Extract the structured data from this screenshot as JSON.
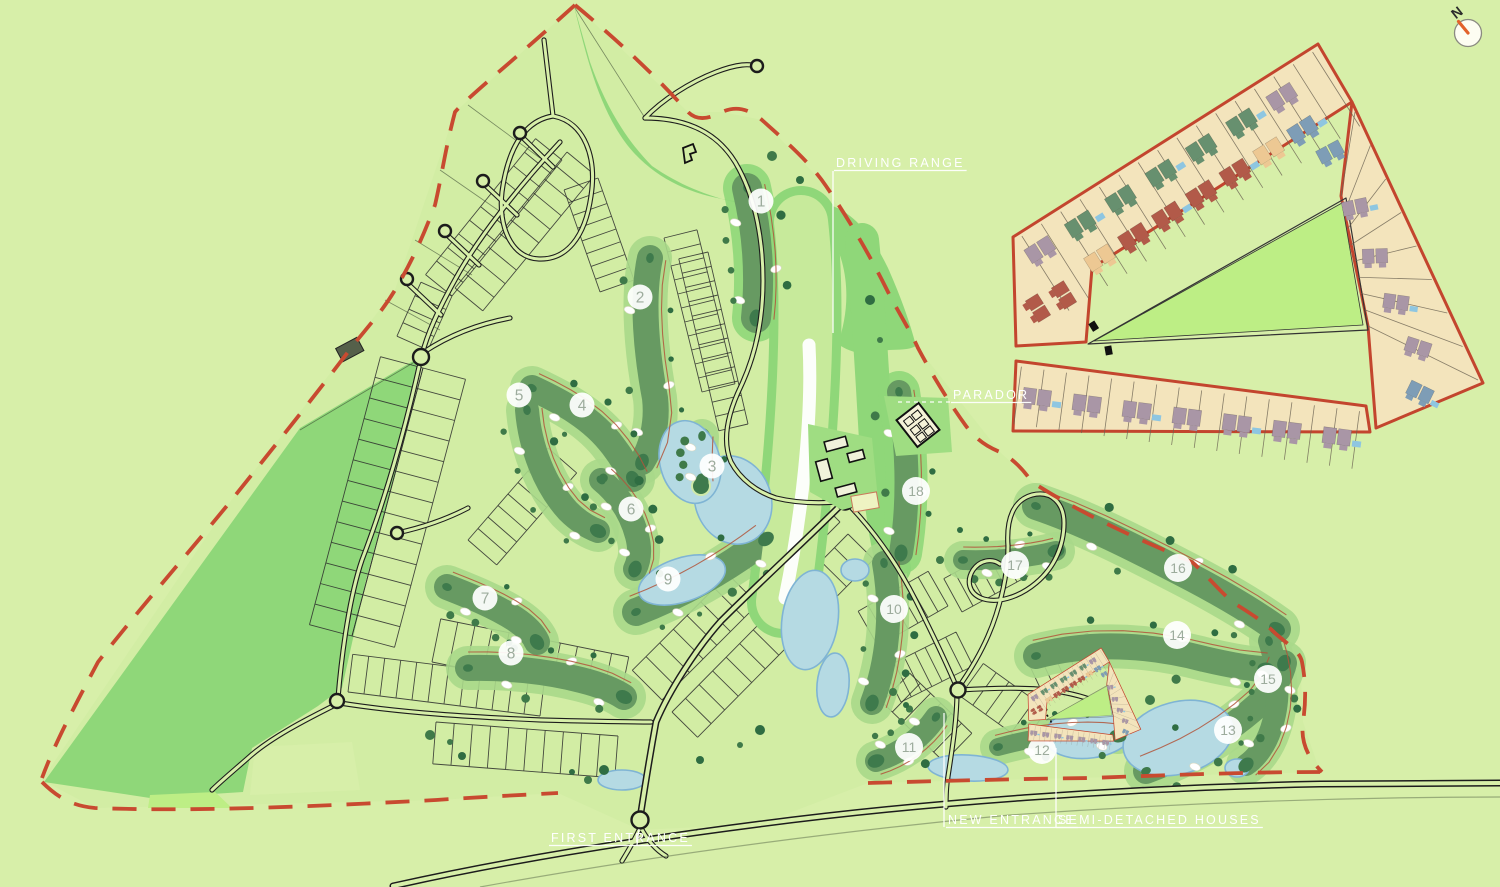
{
  "page": {
    "width": 1500,
    "height": 887
  },
  "compass": {
    "label": "N"
  },
  "labels": [
    {
      "id": "driving-range",
      "text": "DRIVING RANGE",
      "x": 836,
      "y": 167,
      "leader": [
        [
          833,
          171
        ],
        [
          833,
          333
        ]
      ],
      "dashed": false
    },
    {
      "id": "parador",
      "text": "PARADOR",
      "x": 953,
      "y": 399,
      "leader": [
        [
          898,
          402
        ],
        [
          950,
          402
        ]
      ],
      "dashed": true
    },
    {
      "id": "first-entrance",
      "text": "FIRST ENTRANCE",
      "x": 551,
      "y": 842,
      "leader": [
        [
          637,
          845
        ],
        [
          639,
          829
        ]
      ],
      "dashed": false
    },
    {
      "id": "new-entrance",
      "text": "NEW ENTRANCE",
      "x": 948,
      "y": 824,
      "leader": [
        [
          944,
          827
        ],
        [
          944,
          713
        ]
      ],
      "dashed": false
    },
    {
      "id": "semi-detached-houses",
      "text": "SEMI-DETACHED HOUSES",
      "x": 1058,
      "y": 824,
      "leader": [
        [
          1056,
          827
        ],
        [
          1056,
          748
        ]
      ],
      "dashed": false
    }
  ],
  "holes": [
    {
      "number": "1",
      "x": 761,
      "y": 201
    },
    {
      "number": "2",
      "x": 640,
      "y": 297
    },
    {
      "number": "3",
      "x": 712,
      "y": 466
    },
    {
      "number": "4",
      "x": 582,
      "y": 405
    },
    {
      "number": "5",
      "x": 519,
      "y": 395
    },
    {
      "number": "6",
      "x": 631,
      "y": 509
    },
    {
      "number": "7",
      "x": 485,
      "y": 598
    },
    {
      "number": "8",
      "x": 511,
      "y": 653
    },
    {
      "number": "9",
      "x": 668,
      "y": 579
    },
    {
      "number": "10",
      "x": 894,
      "y": 609
    },
    {
      "number": "11",
      "x": 909,
      "y": 747
    },
    {
      "number": "12",
      "x": 1042,
      "y": 750
    },
    {
      "number": "13",
      "x": 1228,
      "y": 730
    },
    {
      "number": "14",
      "x": 1177,
      "y": 635
    },
    {
      "number": "15",
      "x": 1268,
      "y": 679
    },
    {
      "number": "16",
      "x": 1178,
      "y": 568
    },
    {
      "number": "17",
      "x": 1015,
      "y": 565
    },
    {
      "number": "18",
      "x": 916,
      "y": 491
    }
  ],
  "colors": {
    "background": "#d7efa9",
    "woodland": "#8fd779",
    "bright_green": "#bdee85",
    "lawn": "#9fdd82",
    "fairway": "#679a62",
    "fairway_halo": "#a9d889",
    "green_dark": "#3e7a4c",
    "tree1": "#3f7a49",
    "tree2": "#2f6d42",
    "water_fill": "#b5dae3",
    "water_edge": "#7fb4d4",
    "bunker": "#ffffff",
    "road_casing": "#1c1c1c",
    "boundary_red": "#c84a30",
    "cart_path": "#b2553b",
    "label_white": "#ffffff",
    "hole_number": "#9dac9d",
    "plot_line": "#2b2b2b",
    "range_strip": "#c7ea9b",
    "inset_plot": "#f3e4bc",
    "inset_border": "#c3452e",
    "house_green": "#67906f",
    "house_red": "#b25a49",
    "house_mauve": "#a996a6",
    "house_blue": "#7e9db6",
    "house_tan": "#edc893",
    "pool": "#8ec6e1"
  },
  "inset": {
    "upper_row_outer": [
      "mauve",
      "green",
      "green",
      "green",
      "green",
      "green",
      "mauve"
    ],
    "upper_row_inner": [
      "tan",
      "red",
      "red",
      "red",
      "red",
      "tan",
      "blue"
    ],
    "left_pocket": [
      "red",
      "red"
    ],
    "right_wing": [
      "blue",
      "mauve",
      "mauve",
      "mauve",
      "mauve",
      "blue"
    ],
    "bottom_row": [
      "mauve",
      "mauve",
      "mauve",
      "mauve",
      "mauve",
      "mauve",
      "mauve"
    ]
  }
}
